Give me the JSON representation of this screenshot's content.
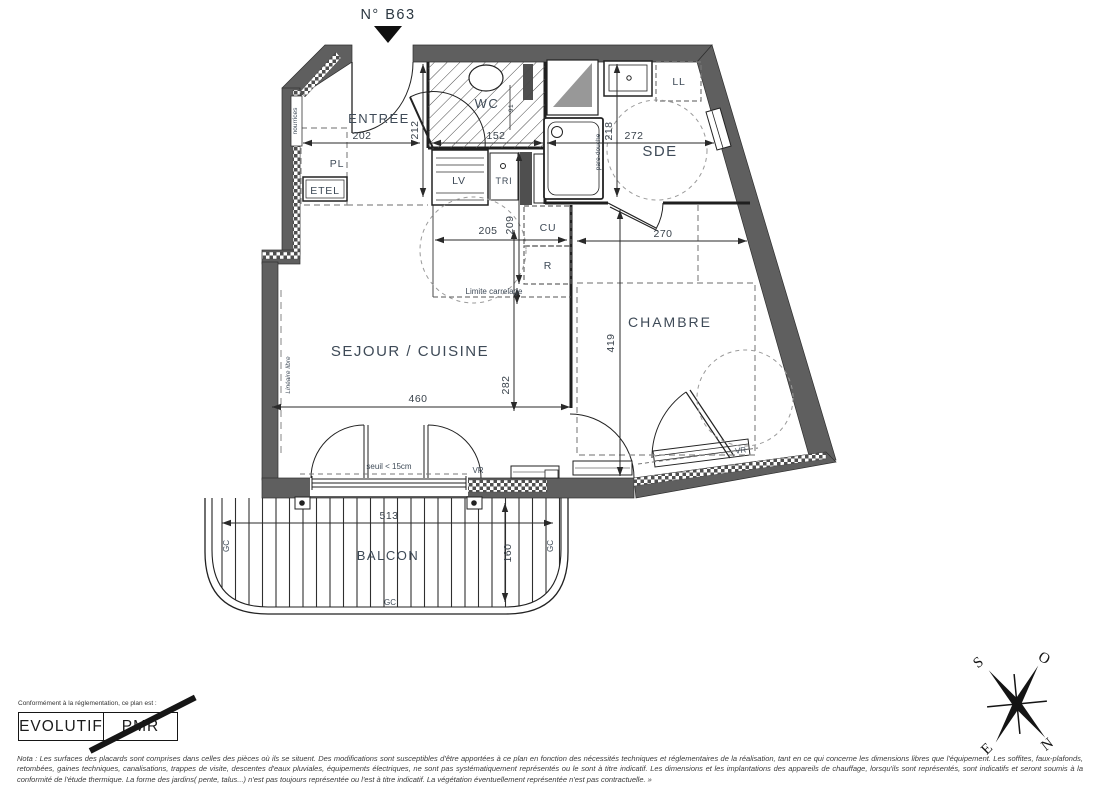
{
  "unit": {
    "number": "N° B63"
  },
  "rooms": {
    "entree": "ENTREE",
    "wc": "WC",
    "sde": "SDE",
    "sejour_cuisine": "SEJOUR / CUISINE",
    "chambre": "CHAMBRE",
    "balcon": "BALCON"
  },
  "fixtures": {
    "placard": "PL",
    "etel": "ETEL",
    "lave_vaisselle": "LV",
    "tri": "TRI",
    "cuisson": "CU",
    "refrigerateur": "R",
    "lave_linge": "LL",
    "nourrices": "nourrices",
    "pare_douche": "pare-douche",
    "volet_roulant": "VR",
    "garde_corps": "GC"
  },
  "annotations": {
    "limite_carrelage": "Limite carrelage",
    "lineaire_libre": "Linéaire libre",
    "seuil": "seuil < 15cm"
  },
  "dimensions": {
    "entree_largeur": "202",
    "entree_profondeur": "212",
    "wc_largeur": "152",
    "wc_porte": "91",
    "sde_largeur": "272",
    "sde_profondeur": "218",
    "cuisine_largeur": "205",
    "cuisine_profondeur": "209",
    "sejour_largeur": "460",
    "sejour_profondeur": "282",
    "chambre_largeur": "270",
    "chambre_profondeur": "419",
    "balcon_largeur": "513",
    "balcon_profondeur": "160"
  },
  "compass": {
    "nord": "N",
    "sud": "S",
    "est": "E",
    "ouest": "O"
  },
  "stamp": {
    "caption": "Conformément à la réglementation, ce plan est :",
    "evolutif": "EVOLUTIF",
    "pmr": "PMR"
  },
  "nota": {
    "text": "Nota : Les surfaces des placards sont comprises dans celles des pièces où ils se situent. Des modifications sont susceptibles d'être apportées à ce plan en fonction des nécessités techniques et réglementaires de la réalisation, tant en ce qui concerne les dimensions libres que l'équipement.  Les soffites, faux-plafonds, retombées, gaines techniques, canalisations, trappes de visite, descentes d'eaux pluviales, équipements électriques, ne sont pas systématiquement représentés ou le sont à titre indicatif. Les dimensions et les implantations des appareils de chauffage, lorsqu'ils sont représentés, sont indicatifs et seront soumis à la conformité de l'étude thermique. La forme des jardins( pente, talus...) n'est pas toujours représentée ou l'est à titre indicatif. La végétation éventuellement représentée n'est pas contractuelle. »"
  }
}
